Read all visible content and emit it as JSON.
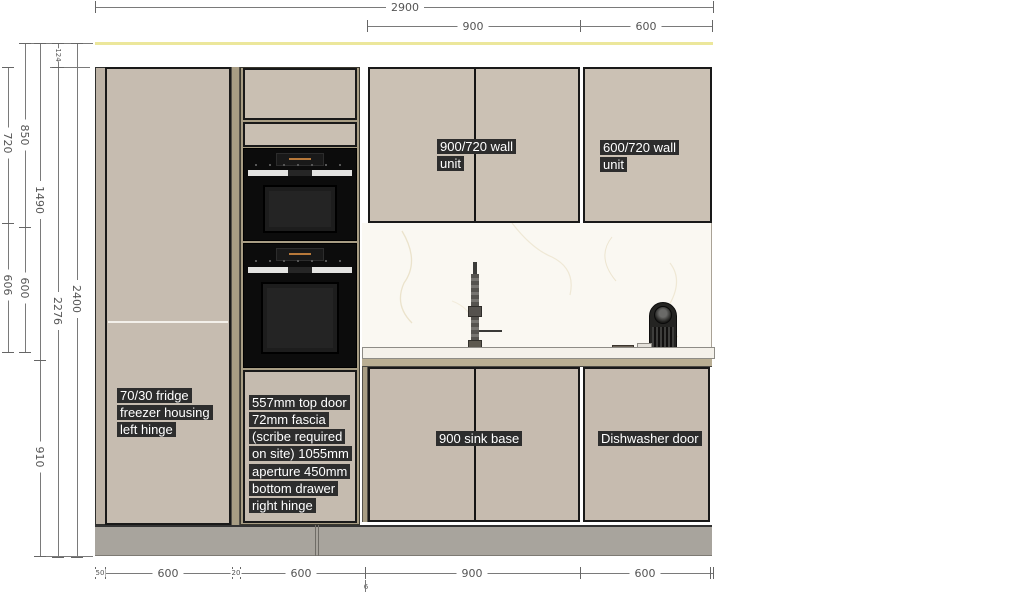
{
  "dimensions": {
    "top": [
      {
        "value": "2900"
      },
      {
        "value": "900"
      },
      {
        "value": "600"
      }
    ],
    "left": [
      {
        "value": "850"
      },
      {
        "value": "720"
      },
      {
        "value": "124"
      },
      {
        "value": "1490"
      },
      {
        "value": "600"
      },
      {
        "value": "606"
      },
      {
        "value": "2400"
      },
      {
        "value": "2276"
      },
      {
        "value": "910"
      }
    ],
    "bottom": [
      {
        "value": "50"
      },
      {
        "value": "600"
      },
      {
        "value": "20"
      },
      {
        "value": "600"
      },
      {
        "value": "6"
      },
      {
        "value": "900"
      },
      {
        "value": "600"
      }
    ]
  },
  "labels": {
    "fridge": "70/30 fridge freezer housing left hinge",
    "oven_stack": "557mm top door 72mm fascia (scribe required on site) 1055mm aperture 450mm bottom drawer right hinge",
    "wall_unit_900": "900/720 wall unit",
    "wall_unit_600": "600/720 wall unit",
    "sink_base": "900 sink base",
    "dishwasher": "Dishwasher door"
  },
  "colors": {
    "cabinet_door": "#c8bdb1",
    "filler": "#a89d84",
    "plinth": "#a8a49d",
    "ceiling_line": "#ece79b",
    "annotation_bg": "#2d2d2d",
    "annotation_text": "#ffffff",
    "dimension_text": "#555555",
    "oven_black": "#0c0c0c",
    "backsplash": "#faf8f2",
    "countertop": "#f4f1ea"
  }
}
